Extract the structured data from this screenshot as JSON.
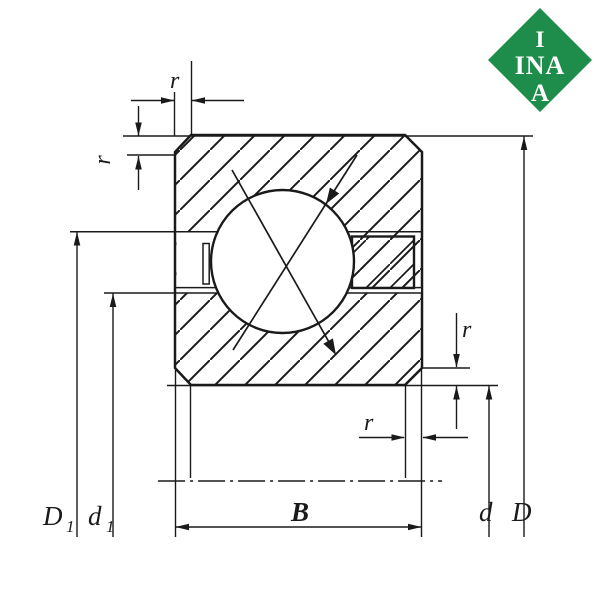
{
  "colors": {
    "line": "#1a1a1a",
    "logo_green": "#1e8c4b",
    "background": "#ffffff"
  },
  "logo": {
    "top": "I",
    "middle": "INA",
    "bottom": "A"
  },
  "dims": {
    "r_top": "r",
    "r_left": "r",
    "r_right": "r",
    "r_bottom": "r",
    "width": "B",
    "outer_diameter": "D",
    "bore_diameter": "d",
    "D1_base": "D",
    "D1_sub": "1",
    "d1_base": "d",
    "d1_sub": "1"
  }
}
